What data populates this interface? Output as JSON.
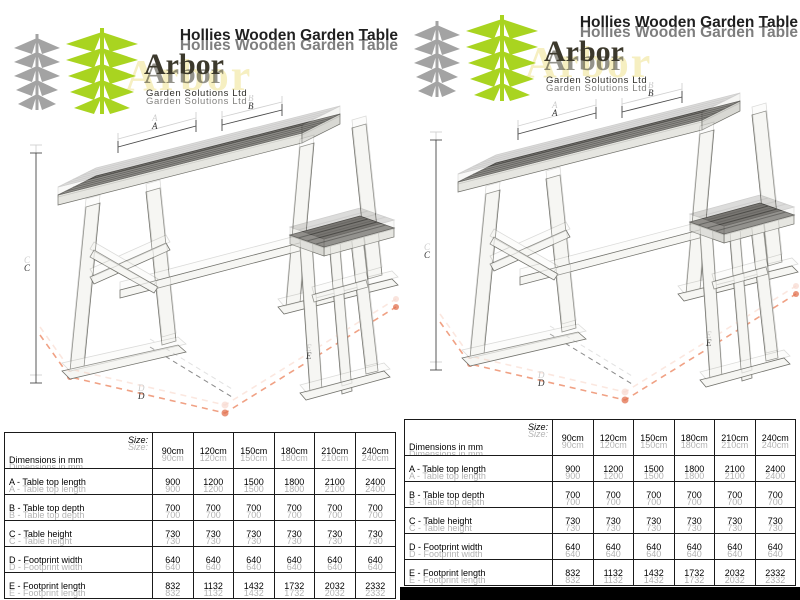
{
  "title": "Hollies Wooden Garden Table",
  "logo": {
    "brand": "Arbor",
    "subtitle": "Garden Solutions Ltd",
    "icon": "tree-leaves-icon"
  },
  "drawing": {
    "description": "isometric CAD drawing of wooden garden table with side table and dashed footprint outline",
    "labels": {
      "a": "A",
      "b": "B",
      "c": "C",
      "d": "D",
      "e": "E"
    }
  },
  "table": {
    "corner_label": "Dimensions in mm",
    "size_label": "Size:",
    "columns": [
      "90cm",
      "120cm",
      "150cm",
      "180cm",
      "210cm",
      "240cm"
    ],
    "rows": [
      {
        "label": "A - Table top length",
        "values": [
          "900",
          "1200",
          "1500",
          "1800",
          "2100",
          "2400"
        ]
      },
      {
        "label": "B - Table top depth",
        "values": [
          "700",
          "700",
          "700",
          "700",
          "700",
          "700"
        ]
      },
      {
        "label": "C - Table height",
        "values": [
          "730",
          "730",
          "730",
          "730",
          "730",
          "730"
        ]
      },
      {
        "label": "D - Footprint width",
        "values": [
          "640",
          "640",
          "640",
          "640",
          "640",
          "640"
        ]
      },
      {
        "label": "E - Footprint length",
        "values": [
          "832",
          "1132",
          "1432",
          "1732",
          "2032",
          "2332"
        ]
      }
    ]
  },
  "colors": {
    "accent_green": "#a9d420",
    "leaf_gray": "#a3a3a3",
    "brand_dark": "#3c392c",
    "ghost_yellow": "#f6efc1",
    "top_gray": "#787672",
    "plank_white": "#f6f6f3",
    "footprint": "#f0a184",
    "dot_red": "#e2704e"
  }
}
